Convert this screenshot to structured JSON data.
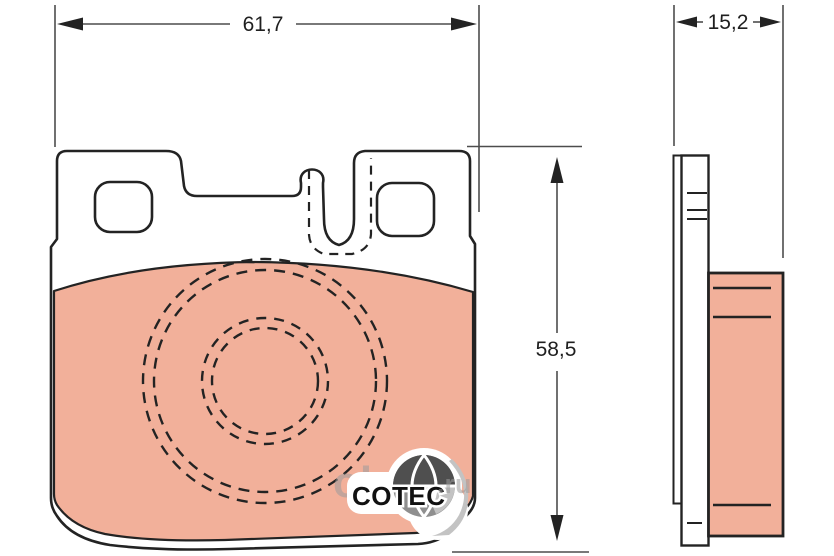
{
  "figure": {
    "type": "technical-drawing",
    "subject": "disc brake pad, front and side projection views",
    "brand": "COTEC",
    "dimensions": {
      "width_label": "61,7",
      "height_label": "58,5",
      "thickness_label": "15,2"
    },
    "watermark": {
      "main": "obeo",
      "suffix": ".ru"
    },
    "colors": {
      "friction_material": "#f2b09a",
      "outline": "#232323",
      "dimension_line": "#4d4d4d",
      "text": "#1f1f1f",
      "globe_dark": "#4f4f4f",
      "globe_mid": "#8f8f8f",
      "globe_light": "#c3c3c3",
      "watermark": "#9c9c9c",
      "background": "#ffffff"
    }
  }
}
